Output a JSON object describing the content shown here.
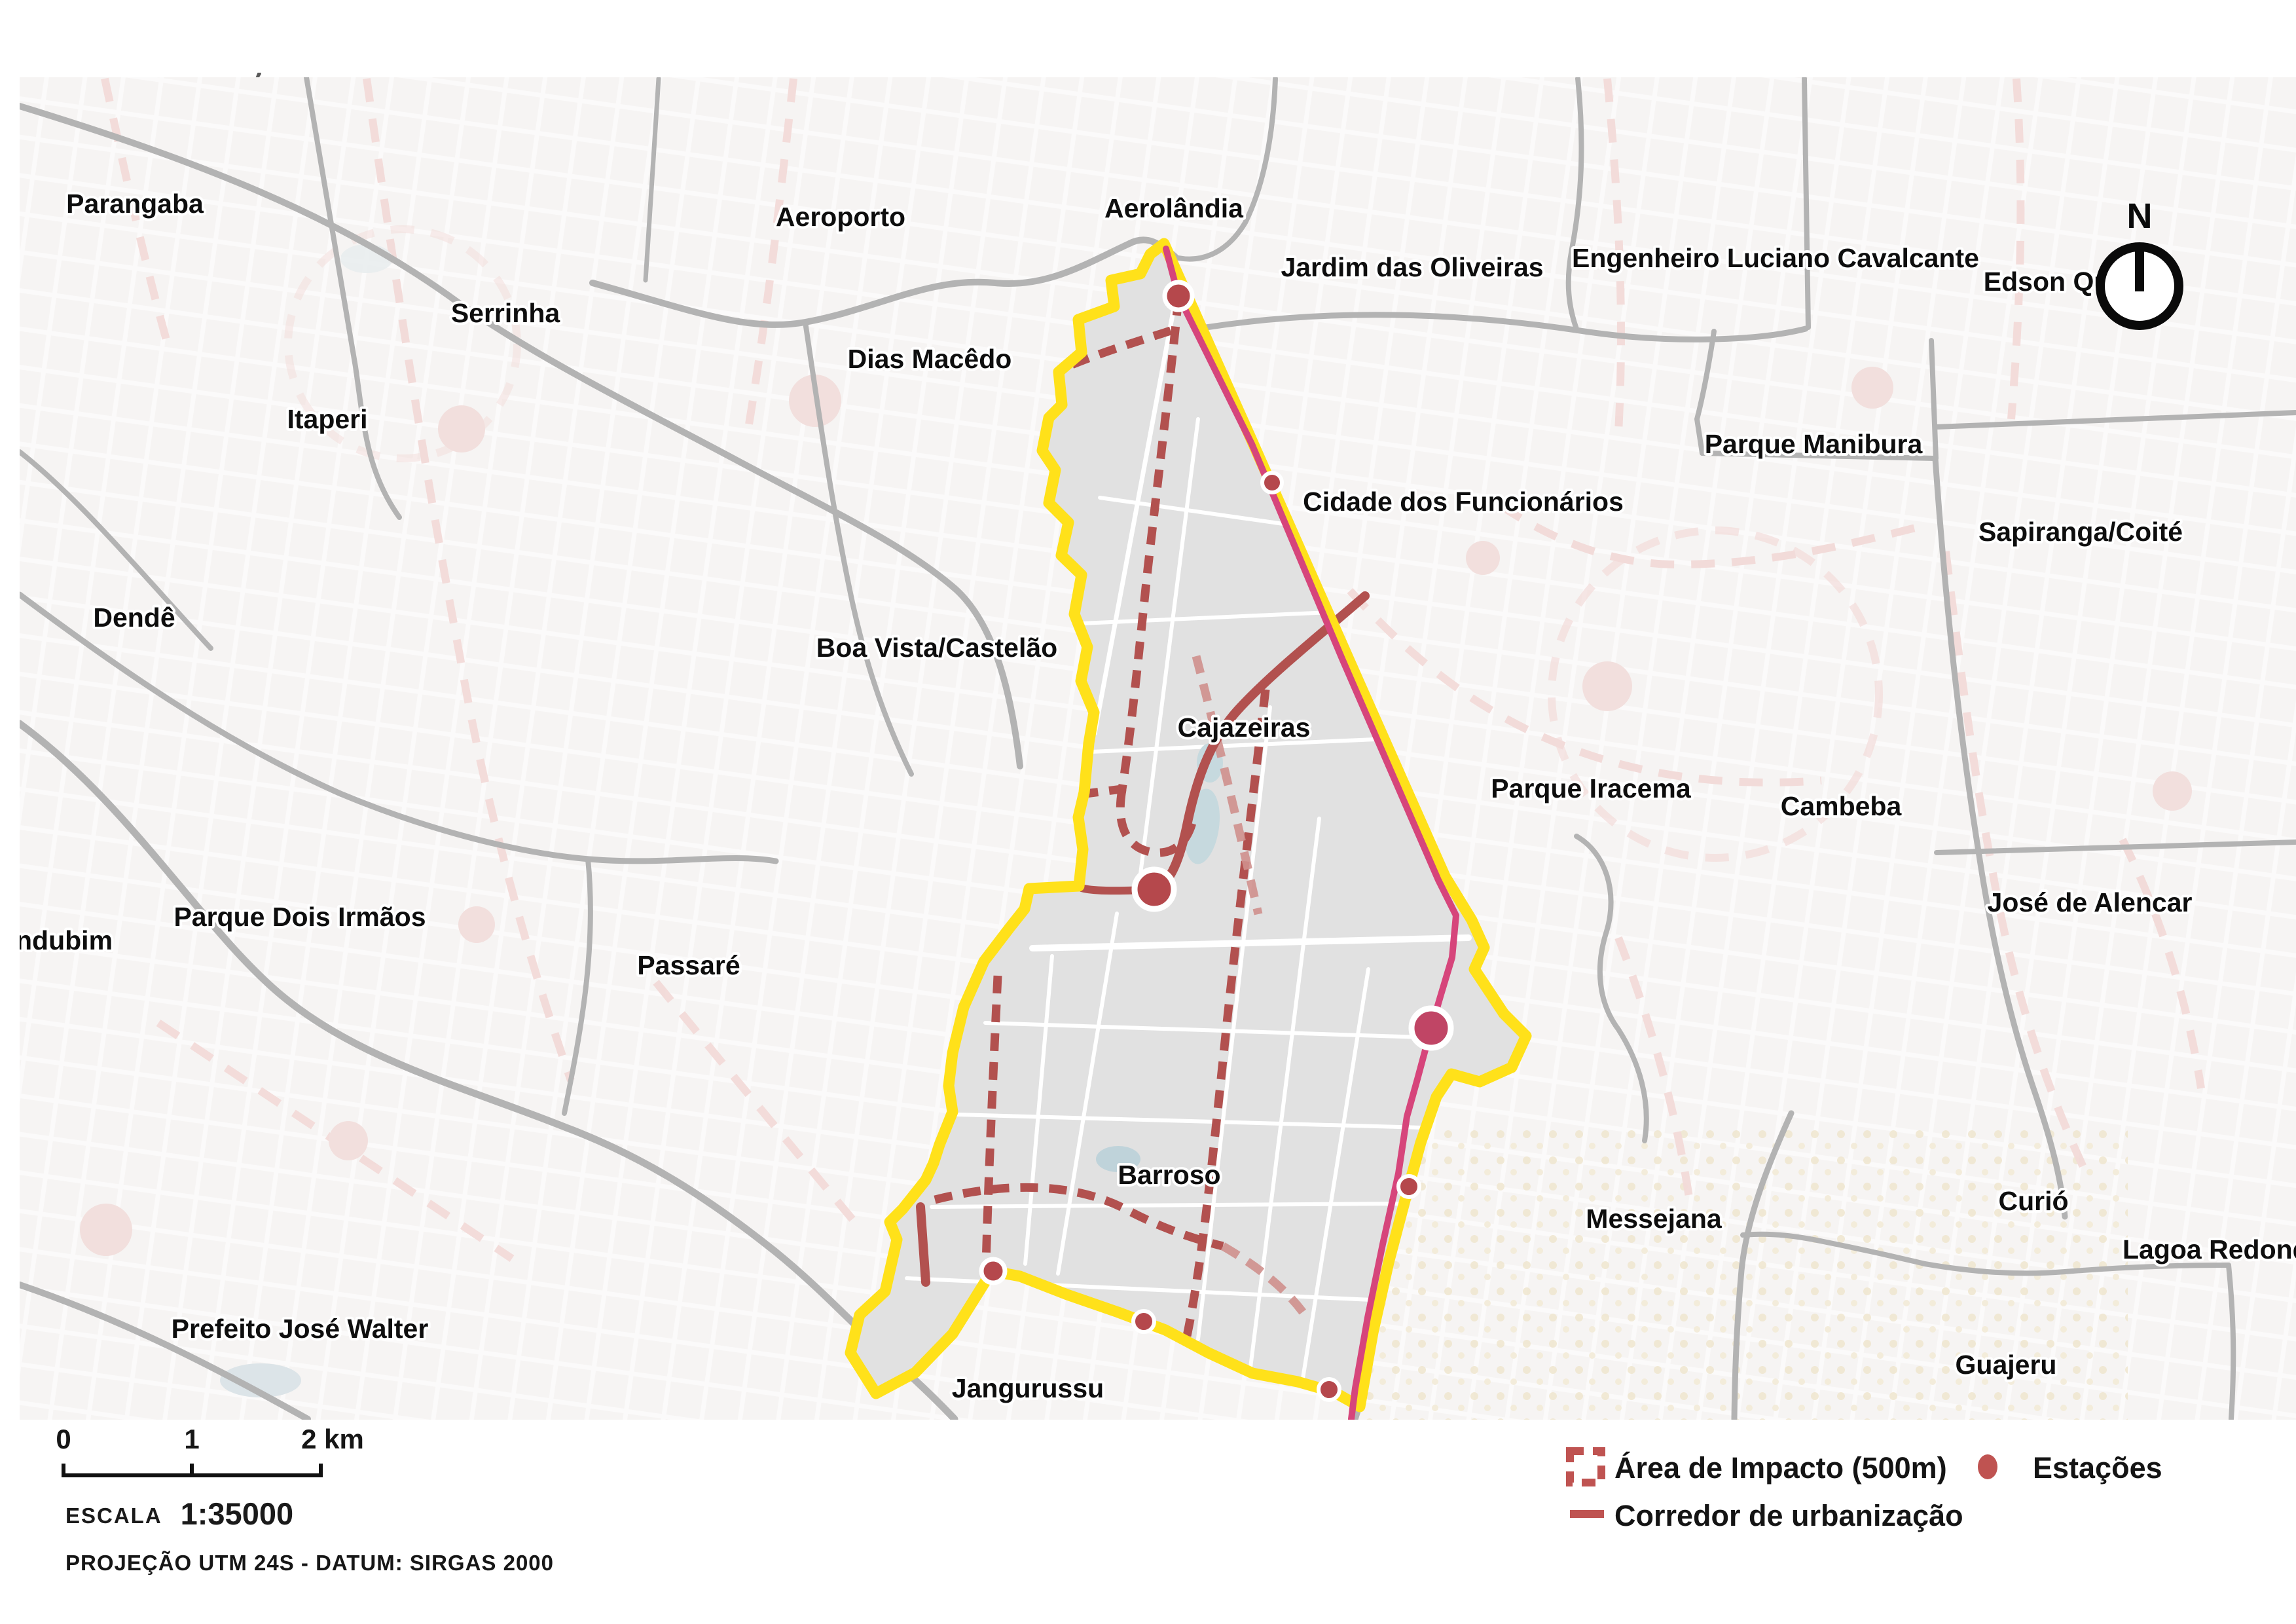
{
  "header": {
    "title": "PLANOS ESPECÍFICOS",
    "brand_name": "FORTALEZA",
    "brand_year": "2040"
  },
  "compass": {
    "north_label": "N"
  },
  "legend": {
    "impact_label": "Área de Impacto (500m)",
    "stations_label": "Estações",
    "corridor_label": "Corredor de urbanização"
  },
  "scalebar": {
    "tick0": "0",
    "tick1": "1",
    "tick2": "2 km",
    "scale_word": "ESCALA",
    "scale_value": "1:35000",
    "projection": "PROJEÇÃO UTM 24S - DATUM: SIRGAS 2000"
  },
  "map": {
    "labels": [
      {
        "text": "Parangaba"
      },
      {
        "text": "Aeroporto"
      },
      {
        "text": "Aerolândia"
      },
      {
        "text": "Jardim das Oliveiras"
      },
      {
        "text": "Engenheiro Luciano Cavalcante"
      },
      {
        "text": "Edson Que"
      },
      {
        "text": "Serrinha"
      },
      {
        "text": "Dias Macêdo"
      },
      {
        "text": "Parque Manibura"
      },
      {
        "text": "Cidade dos Funcionários"
      },
      {
        "text": "Sapiranga/Coité"
      },
      {
        "text": "Itaperi"
      },
      {
        "text": "Dendê"
      },
      {
        "text": "Boa Vista/Castelão"
      },
      {
        "text": "Cajazeiras"
      },
      {
        "text": "Parque Iracema"
      },
      {
        "text": "Cambeba"
      },
      {
        "text": "José de Alencar"
      },
      {
        "text": "Parque Dois Irmãos"
      },
      {
        "text": "ndubim"
      },
      {
        "text": "Passaré"
      },
      {
        "text": "Barroso"
      },
      {
        "text": "Messejana"
      },
      {
        "text": "Curió"
      },
      {
        "text": "Lagoa Redond"
      },
      {
        "text": "Guajeru"
      },
      {
        "text": "Jangurussu"
      },
      {
        "text": "Prefeito José Walter"
      }
    ]
  },
  "colors": {
    "plan_boundary_yellow": "#ffe11a",
    "corridor_red": "#b2514f",
    "impact_dash_red": "#b2514f",
    "impact_dash_light": "#cf908d",
    "transit_magenta": "#d6457b",
    "station_red": "#b5484c",
    "road_gray": "#b3b3b3",
    "faded_road_pink": "#f2dad8",
    "plan_fill": "#e1e1e1",
    "base": "#f6f4f3",
    "title_gray": "#595959",
    "brand_gray": "#8f8f8f"
  }
}
